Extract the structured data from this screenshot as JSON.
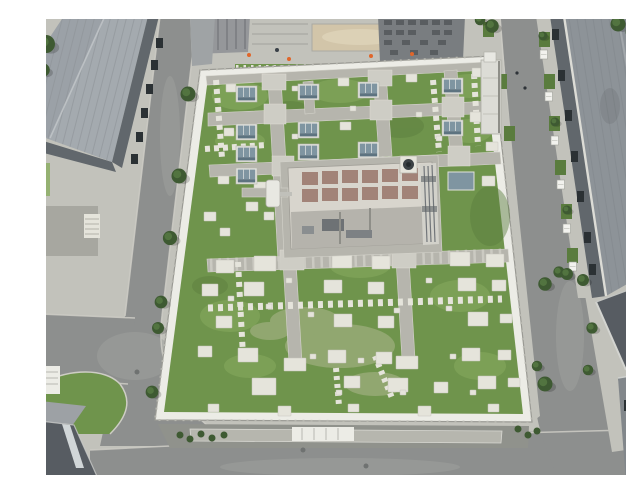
{
  "meta": {
    "alt": "Top-down aerial drone photo of an industrial campus: a large flat building with an extensive green roof crossed by a grid of paved walkways, glass skylight boxes, concrete equipment pads and a central rooftop plant room with a chimney; dark asphalt roads with trees surround it, flanked by long grey-roofed warehouse buildings on the left and right and dark-roofed buildings in the corners."
  },
  "scene": {
    "description": "Green roof of a utility building seen from directly above, with lawn, walkway grid, skylights, stepping-stone paths, equipment pads, perimeter parapet walls, surrounding service roads, street trees and neighbouring warehouse roofs.",
    "colors": {
      "frame": "#ffffff",
      "asphalt": "#8d8f8e",
      "asphaltlight": "#9ea09d",
      "concrete": "#c2c2bb",
      "concretedark": "#a7a7a0",
      "walkway": "#b6b5ad",
      "walklight": "#cecdc5",
      "pad": "#e5e4db",
      "parapet": "#ecece6",
      "grass": "#6f944c",
      "grasslight": "#8aad60",
      "grassdark": "#5a7c3e",
      "grassworn": "#a8b488",
      "tree": "#3e5a32",
      "treehi": "#547741",
      "metal": "#a4aaaf",
      "metaldark": "#8d9398",
      "facade": "#61676c",
      "win": "#2b3134",
      "darkroof": "#575c62",
      "skytop": "#7f95a1",
      "skyside": "#5d7380",
      "plant": "#d8d5cd",
      "patch": "#99756a",
      "sand": "#d2c5a9",
      "cone": "#e0662a",
      "steel": "#797d80",
      "ink": "#2e3338"
    },
    "features": {
      "skylights": [
        [
          196,
          70
        ],
        [
          258,
          68
        ],
        [
          318,
          66
        ],
        [
          402,
          62
        ],
        [
          196,
          108
        ],
        [
          258,
          106
        ],
        [
          402,
          104
        ],
        [
          196,
          130
        ],
        [
          258,
          128
        ],
        [
          318,
          126
        ],
        [
          196,
          152
        ],
        [
          258,
          150
        ]
      ],
      "pads": [
        [
          186,
          68,
          10,
          8
        ],
        [
          298,
          62,
          11,
          8
        ],
        [
          366,
          58,
          11,
          8
        ],
        [
          432,
          52,
          12,
          9
        ],
        [
          184,
          112,
          10,
          8
        ],
        [
          300,
          106,
          11,
          8
        ],
        [
          430,
          96,
          13,
          10
        ],
        [
          446,
          126,
          12,
          9
        ],
        [
          178,
          160,
          11,
          8
        ],
        [
          214,
          166,
          14,
          10
        ],
        [
          442,
          160,
          13,
          10
        ],
        [
          164,
          196,
          12,
          9
        ],
        [
          180,
          212,
          10,
          8
        ],
        [
          176,
          244,
          18,
          13
        ],
        [
          214,
          240,
          22,
          15
        ],
        [
          292,
          238,
          20,
          14
        ],
        [
          332,
          240,
          18,
          13
        ],
        [
          410,
          236,
          20,
          14
        ],
        [
          446,
          238,
          18,
          13
        ],
        [
          162,
          268,
          16,
          12
        ],
        [
          204,
          266,
          20,
          14
        ],
        [
          284,
          264,
          18,
          13
        ],
        [
          328,
          266,
          16,
          12
        ],
        [
          418,
          262,
          18,
          13
        ],
        [
          452,
          264,
          14,
          11
        ],
        [
          176,
          300,
          16,
          12
        ],
        [
          294,
          298,
          18,
          13
        ],
        [
          338,
          300,
          16,
          12
        ],
        [
          428,
          296,
          20,
          14
        ],
        [
          460,
          298,
          12,
          9
        ],
        [
          158,
          330,
          14,
          11
        ],
        [
          198,
          332,
          20,
          14
        ],
        [
          288,
          334,
          18,
          13
        ],
        [
          336,
          336,
          16,
          12
        ],
        [
          422,
          332,
          18,
          13
        ],
        [
          458,
          334,
          13,
          10
        ],
        [
          212,
          362,
          24,
          17
        ],
        [
          304,
          360,
          16,
          12
        ],
        [
          348,
          362,
          20,
          14
        ],
        [
          394,
          366,
          14,
          11
        ],
        [
          438,
          360,
          18,
          13
        ],
        [
          468,
          362,
          12,
          9
        ],
        [
          168,
          388,
          11,
          8
        ],
        [
          238,
          390,
          13,
          10
        ],
        [
          308,
          388,
          11,
          8
        ],
        [
          378,
          390,
          13,
          10
        ],
        [
          448,
          388,
          11,
          8
        ],
        [
          252,
          70,
          6,
          5
        ],
        [
          252,
          118,
          6,
          5
        ],
        [
          310,
          90,
          6,
          5
        ],
        [
          376,
          96,
          6,
          5
        ],
        [
          396,
          120,
          6,
          5
        ],
        [
          226,
          288,
          6,
          5
        ],
        [
          268,
          296,
          6,
          5
        ],
        [
          354,
          292,
          6,
          5
        ],
        [
          406,
          290,
          6,
          5
        ],
        [
          270,
          338,
          6,
          5
        ],
        [
          318,
          342,
          6,
          5
        ],
        [
          410,
          338,
          6,
          5
        ],
        [
          296,
          374,
          6,
          5
        ],
        [
          360,
          374,
          6,
          5
        ],
        [
          430,
          374,
          6,
          5
        ],
        [
          188,
          280,
          6,
          5
        ],
        [
          246,
          262,
          6,
          5
        ],
        [
          386,
          262,
          6,
          5
        ],
        [
          612,
          4,
          8,
          6
        ],
        [
          618,
          12,
          7,
          5
        ],
        [
          206,
          186,
          12,
          9
        ],
        [
          224,
          196,
          10,
          8
        ],
        [
          244,
          342,
          22,
          13
        ],
        [
          356,
          340,
          22,
          13
        ]
      ],
      "trees": [
        [
          148,
          78,
          1
        ],
        [
          139,
          160,
          1
        ],
        [
          130,
          222,
          0.95
        ],
        [
          121,
          286,
          0.85
        ],
        [
          118,
          312,
          0.8
        ],
        [
          112,
          376,
          0.85
        ],
        [
          6,
          28,
          1.2
        ],
        [
          3,
          54,
          0.9
        ],
        [
          452,
          10,
          0.9
        ],
        [
          440,
          4,
          0.7
        ],
        [
          578,
          8,
          1
        ],
        [
          592,
          16,
          0.85
        ],
        [
          505,
          268,
          0.9
        ],
        [
          519,
          256,
          0.75
        ],
        [
          543,
          264,
          0.8
        ],
        [
          505,
          368,
          1
        ],
        [
          497,
          350,
          0.7
        ],
        [
          527,
          258,
          0.8
        ],
        [
          552,
          312,
          0.75
        ],
        [
          548,
          354,
          0.7
        ],
        [
          503,
          20,
          0.6
        ],
        [
          515,
          106,
          0.6
        ],
        [
          527,
          194,
          0.6
        ]
      ],
      "ac_units": [
        [
          500,
          34
        ],
        [
          505,
          76
        ],
        [
          511,
          120
        ],
        [
          517,
          164
        ],
        [
          523,
          208
        ],
        [
          529,
          246
        ]
      ],
      "grass_cells": [
        [
          499,
          16
        ],
        [
          504,
          58
        ],
        [
          509,
          100
        ],
        [
          515,
          144
        ],
        [
          521,
          188
        ],
        [
          527,
          232
        ],
        [
          443,
          6
        ],
        [
          456,
          58
        ],
        [
          464,
          110
        ]
      ],
      "bushes": [
        [
          140,
          419
        ],
        [
          150,
          423
        ],
        [
          161,
          418
        ],
        [
          172,
          422
        ],
        [
          184,
          419
        ],
        [
          478,
          413
        ],
        [
          488,
          419
        ],
        [
          497,
          415
        ]
      ],
      "manholes": [
        [
          97,
          356
        ],
        [
          263,
          434
        ],
        [
          326,
          450
        ]
      ],
      "people": [
        [
          477,
          57
        ],
        [
          485,
          72
        ]
      ],
      "cones": [
        [
          209,
          39
        ],
        [
          249,
          43
        ],
        [
          331,
          40
        ],
        [
          372,
          38
        ]
      ],
      "windows_left": [
        [
          116,
          22
        ],
        [
          111,
          44
        ],
        [
          106,
          68
        ],
        [
          101,
          92
        ],
        [
          96,
          116
        ],
        [
          91,
          138
        ]
      ],
      "windows_right": [
        [
          512,
          13
        ],
        [
          518,
          54
        ],
        [
          525,
          94
        ],
        [
          531,
          135
        ],
        [
          537,
          175
        ],
        [
          544,
          216
        ],
        [
          549,
          248
        ]
      ]
    }
  }
}
